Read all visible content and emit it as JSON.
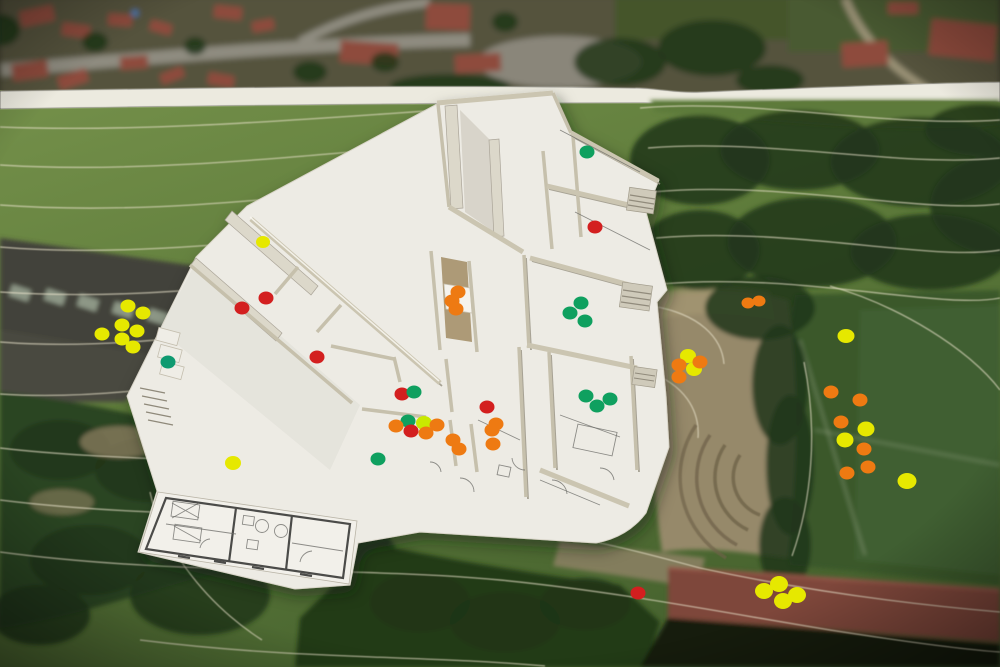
{
  "scene": {
    "subject": "architectural-scale-model-on-aerial-site-plan",
    "medium": "photograph",
    "annotation_method": "colored-sticker-dots"
  },
  "palette": {
    "yellow": "#e6e800",
    "orange": "#ee7a12",
    "red": "#d31f1f",
    "green": "#0fa05f",
    "teal": "#0f9a70",
    "chartreuse": "#c9e900"
  },
  "dot_default_size": {
    "rx": 7.5,
    "ry": 6.5
  },
  "sticker_dots": [
    {
      "x": 128,
      "y": 306,
      "color": "yellow"
    },
    {
      "x": 143,
      "y": 313,
      "color": "yellow"
    },
    {
      "x": 122,
      "y": 325,
      "color": "yellow"
    },
    {
      "x": 137,
      "y": 331,
      "color": "yellow"
    },
    {
      "x": 102,
      "y": 334,
      "color": "yellow"
    },
    {
      "x": 122,
      "y": 339,
      "color": "yellow"
    },
    {
      "x": 133,
      "y": 347,
      "color": "yellow"
    },
    {
      "x": 168,
      "y": 362,
      "color": "teal"
    },
    {
      "x": 263,
      "y": 242,
      "color": "yellow",
      "rx": 7,
      "ry": 6
    },
    {
      "x": 242,
      "y": 308,
      "color": "red"
    },
    {
      "x": 266,
      "y": 298,
      "color": "red"
    },
    {
      "x": 317,
      "y": 357,
      "color": "red"
    },
    {
      "x": 233,
      "y": 463,
      "color": "yellow",
      "rx": 8,
      "ry": 7
    },
    {
      "x": 378,
      "y": 459,
      "color": "green"
    },
    {
      "x": 587,
      "y": 152,
      "color": "green"
    },
    {
      "x": 595,
      "y": 227,
      "color": "red"
    },
    {
      "x": 458,
      "y": 292,
      "color": "orange"
    },
    {
      "x": 452,
      "y": 301,
      "color": "orange"
    },
    {
      "x": 456,
      "y": 309,
      "color": "orange"
    },
    {
      "x": 402,
      "y": 394,
      "color": "red"
    },
    {
      "x": 414,
      "y": 392,
      "color": "green"
    },
    {
      "x": 408,
      "y": 421,
      "color": "green"
    },
    {
      "x": 424,
      "y": 423,
      "color": "chartreuse",
      "rx": 8,
      "ry": 7
    },
    {
      "x": 396,
      "y": 426,
      "color": "orange"
    },
    {
      "x": 411,
      "y": 431,
      "color": "red"
    },
    {
      "x": 437,
      "y": 425,
      "color": "orange"
    },
    {
      "x": 426,
      "y": 433,
      "color": "orange"
    },
    {
      "x": 487,
      "y": 407,
      "color": "red"
    },
    {
      "x": 496,
      "y": 424,
      "color": "orange"
    },
    {
      "x": 492,
      "y": 430,
      "color": "orange"
    },
    {
      "x": 453,
      "y": 440,
      "color": "orange"
    },
    {
      "x": 459,
      "y": 449,
      "color": "orange"
    },
    {
      "x": 493,
      "y": 444,
      "color": "orange"
    },
    {
      "x": 581,
      "y": 303,
      "color": "green"
    },
    {
      "x": 570,
      "y": 313,
      "color": "green"
    },
    {
      "x": 585,
      "y": 321,
      "color": "green"
    },
    {
      "x": 586,
      "y": 396,
      "color": "green"
    },
    {
      "x": 597,
      "y": 406,
      "color": "green"
    },
    {
      "x": 610,
      "y": 399,
      "color": "green"
    },
    {
      "x": 688,
      "y": 356,
      "color": "yellow",
      "rx": 8,
      "ry": 7
    },
    {
      "x": 694,
      "y": 369,
      "color": "yellow",
      "rx": 8,
      "ry": 7
    },
    {
      "x": 679,
      "y": 365,
      "color": "orange"
    },
    {
      "x": 679,
      "y": 377,
      "color": "orange"
    },
    {
      "x": 700,
      "y": 362,
      "color": "orange"
    },
    {
      "x": 748,
      "y": 303,
      "color": "orange",
      "rx": 6.5,
      "ry": 5.5
    },
    {
      "x": 759,
      "y": 301,
      "color": "orange",
      "rx": 6.5,
      "ry": 5.5
    },
    {
      "x": 846,
      "y": 336,
      "color": "yellow",
      "rx": 8.5,
      "ry": 7
    },
    {
      "x": 831,
      "y": 392,
      "color": "orange"
    },
    {
      "x": 860,
      "y": 400,
      "color": "orange"
    },
    {
      "x": 841,
      "y": 422,
      "color": "orange"
    },
    {
      "x": 866,
      "y": 429,
      "color": "yellow",
      "rx": 8.5,
      "ry": 7.5
    },
    {
      "x": 845,
      "y": 440,
      "color": "yellow",
      "rx": 8.5,
      "ry": 7.5
    },
    {
      "x": 864,
      "y": 449,
      "color": "orange"
    },
    {
      "x": 868,
      "y": 467,
      "color": "orange"
    },
    {
      "x": 847,
      "y": 473,
      "color": "orange"
    },
    {
      "x": 907,
      "y": 481,
      "color": "yellow",
      "rx": 9.5,
      "ry": 8
    },
    {
      "x": 638,
      "y": 593,
      "color": "red"
    },
    {
      "x": 764,
      "y": 591,
      "color": "yellow",
      "rx": 9,
      "ry": 8
    },
    {
      "x": 779,
      "y": 584,
      "color": "yellow",
      "rx": 9,
      "ry": 8
    },
    {
      "x": 783,
      "y": 601,
      "color": "yellow",
      "rx": 9,
      "ry": 8
    },
    {
      "x": 797,
      "y": 595,
      "color": "yellow",
      "rx": 9,
      "ry": 8
    }
  ]
}
